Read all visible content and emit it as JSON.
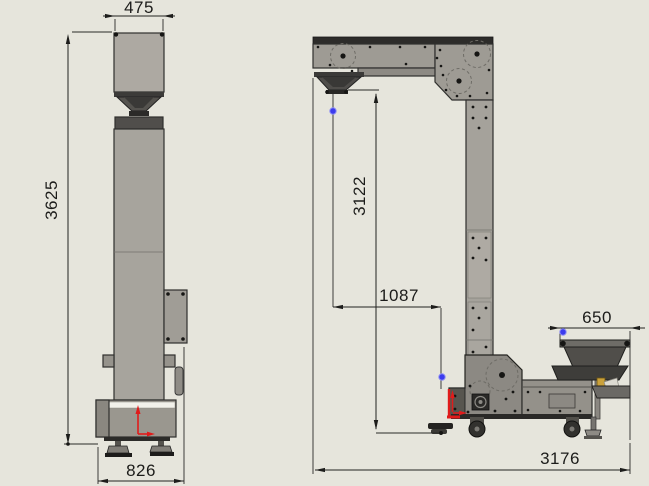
{
  "drawing": {
    "dimensions": {
      "head_width": "475",
      "overall_height": "3625",
      "base_width": "826",
      "discharge_height": "3122",
      "discharge_offset": "1087",
      "infeed_width": "650",
      "overall_length": "3176"
    },
    "colors": {
      "background": "#e6e5dc",
      "machine_gray": "#a7a49d",
      "machine_dark": "#4f4d4a",
      "dimension_ink": "#222220",
      "origin_red": "#e01b1b",
      "vertex_blue": "#3c3cee"
    },
    "markers": {
      "origin_marker": "red-origin-arrows",
      "vertex_dot": "blue-vertex-point"
    }
  }
}
